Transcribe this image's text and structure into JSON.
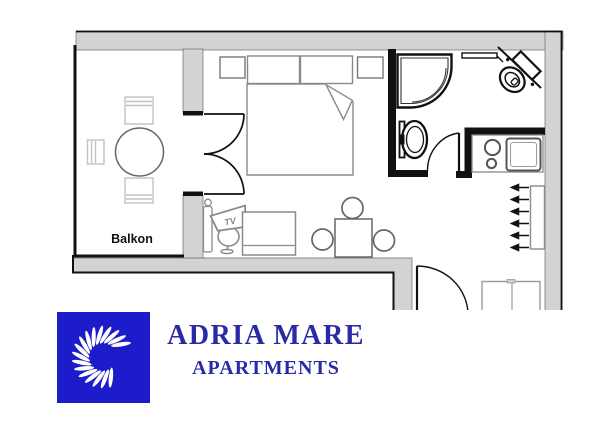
{
  "floor_plan": {
    "balcony_label": "Balkon",
    "tv_label": "TV",
    "fixtures": [
      "balcony-round-table-with-three-chairs",
      "french-double-door-to-balcony",
      "double-bed-with-pillows-and-fold",
      "two-nightstands",
      "floor-lamp",
      "tv-on-pedestal-stand",
      "sofa",
      "dining-table-with-three-chairs",
      "corner-shower",
      "washbasin",
      "toilet",
      "towel-rail",
      "kitchenette-counter-with-sink-and-cooktop",
      "wardrobe-rack-with-hangers",
      "entry-bench",
      "bathroom-door",
      "entrance-door",
      "entrance-marker-triangle"
    ],
    "colors": {
      "wall_fill": "#d3d3d3",
      "wall_outline": "#111111",
      "partition_black": "#111111",
      "furniture_stroke": "#8a8a8a",
      "balcony_chair_stroke": "#c2c2c2"
    }
  },
  "branding": {
    "title": "ADRIA MARE",
    "subtitle": "APARTMENTS",
    "colors": {
      "logo_background": "#1c1ccb",
      "logo_rays": "#ffffff",
      "text": "#2a2aa6"
    }
  }
}
